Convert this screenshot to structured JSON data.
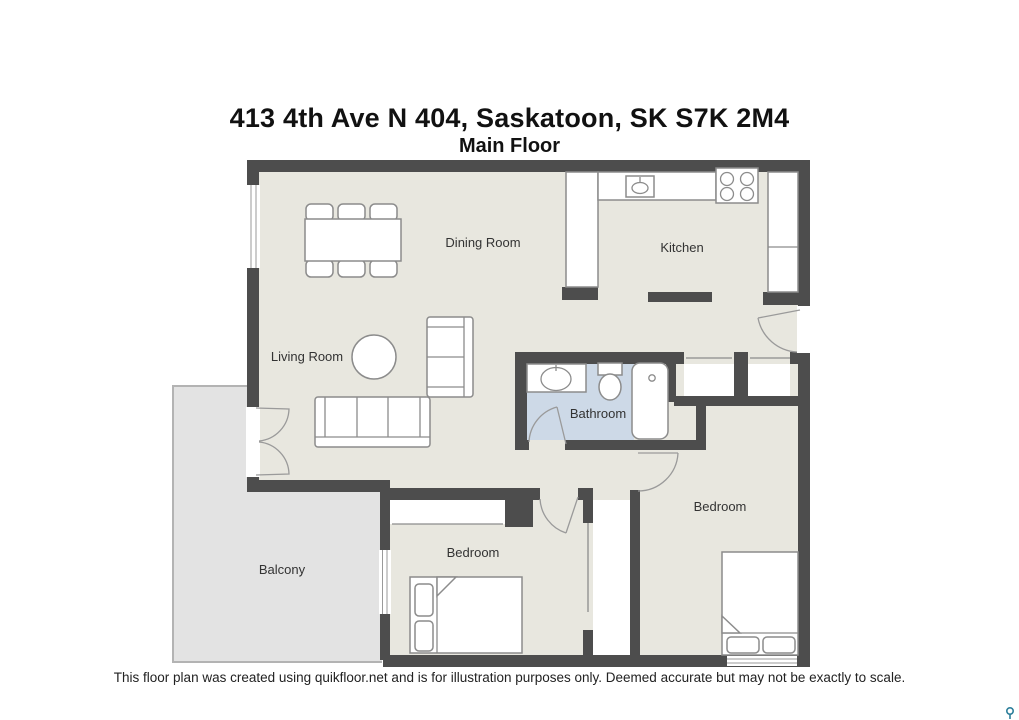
{
  "header": {
    "title": "413 4th Ave N 404, Saskatoon, SK S7K 2M4",
    "subtitle": "Main Floor"
  },
  "rooms": {
    "dining": {
      "label": "Dining Room"
    },
    "kitchen": {
      "label": "Kitchen"
    },
    "living": {
      "label": "Living Room"
    },
    "bathroom": {
      "label": "Bathroom"
    },
    "bedroom_small": {
      "label": "Bedroom"
    },
    "bedroom_large": {
      "label": "Bedroom"
    },
    "balcony": {
      "label": "Balcony"
    }
  },
  "footer": {
    "disclaimer": "This floor plan was created using quikfloor.net and is for illustration purposes only. Deemed accurate but may not be exactly to scale."
  },
  "colors": {
    "wall": "#4d4d4d",
    "floor": "#e8e7df",
    "bath-floor": "#cdd9e7",
    "balcony-floor": "#e3e3e3",
    "railing": "#b3b3b3",
    "outline": "#8c8c8c",
    "furniture": "#ffffff",
    "label-text": "#333333",
    "title-text": "#111111",
    "watermark": "#2d7f9b"
  }
}
